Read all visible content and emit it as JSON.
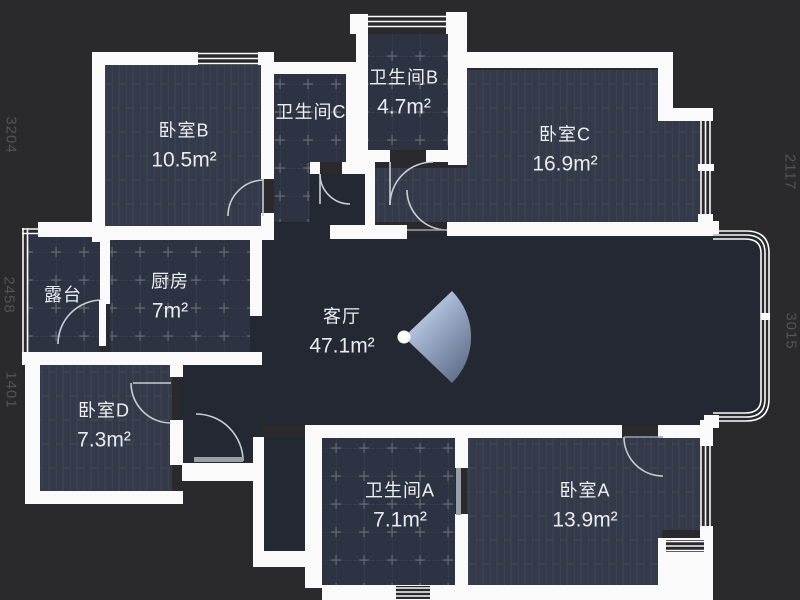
{
  "floorplan": {
    "rooms": [
      {
        "id": "bedroom-b",
        "name": "卧室B",
        "area": "10.5m²"
      },
      {
        "id": "bathroom-c",
        "name": "卫生间C",
        "area": ""
      },
      {
        "id": "bathroom-b",
        "name": "卫生间B",
        "area": "4.7m²"
      },
      {
        "id": "bedroom-c",
        "name": "卧室C",
        "area": "16.9m²"
      },
      {
        "id": "terrace",
        "name": "露台",
        "area": ""
      },
      {
        "id": "kitchen",
        "name": "厨房",
        "area": "7m²"
      },
      {
        "id": "living",
        "name": "客厅",
        "area": "47.1m²"
      },
      {
        "id": "bedroom-d",
        "name": "卧室D",
        "area": "7.3m²"
      },
      {
        "id": "bathroom-a",
        "name": "卫生间A",
        "area": "7.1m²"
      },
      {
        "id": "bedroom-a",
        "name": "卧室A",
        "area": "13.9m²"
      }
    ],
    "dimensions": {
      "left": [
        "3204",
        "2458",
        "1401"
      ],
      "right": [
        "2117",
        "3015"
      ]
    },
    "colors": {
      "background": "#2a2a2c",
      "wall": "#fafafa",
      "floor_open": "#232833",
      "floor_room": "#343a49",
      "floor_tile": "#2d3343",
      "cone_light": "#dde6f2",
      "cone_dark": "#62718b"
    }
  }
}
